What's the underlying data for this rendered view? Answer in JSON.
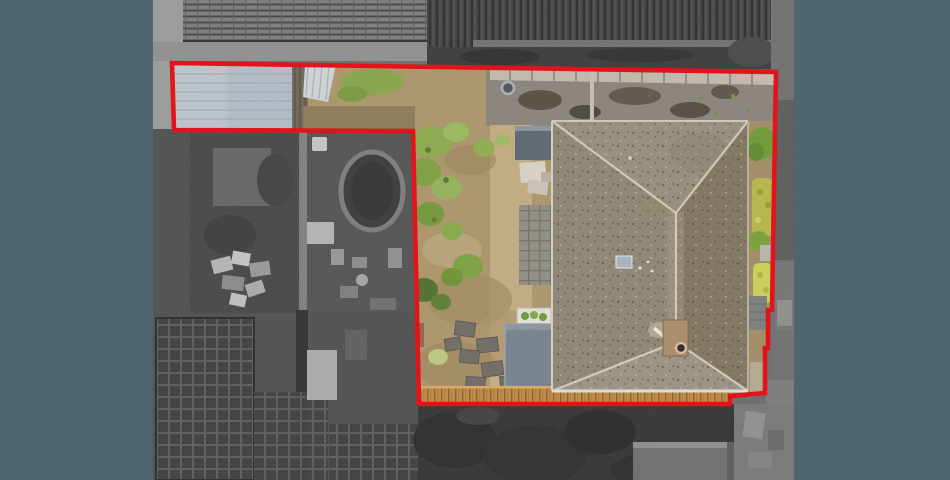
{
  "scene": {
    "type": "aerial-property-photograph",
    "alt": "Top-down aerial drone photograph of a detached house with a grey hipped roof, rear garden with dry lawn, shrubs, paving and timber decking, and a pale grey outbuilding roof. The property plot is outlined with a thick red boundary line; everything outside the boundary (neighbouring gardens, pool, sheds, roofs, driveway) is desaturated to greyscale. Dark slate-blue bars fill the left and right edges of the frame.",
    "visible_text": []
  },
  "colors": {
    "backdrop_slate": "#4C6670",
    "boundary_red": "#E2131A",
    "outside_grey": "#6C6C6C",
    "house_roof_grey": "#8E8575",
    "garden_tan": "#B29A72",
    "shed_roof_blue_grey": "#B4BEC6",
    "deck_wood": "#BF8A45",
    "hedge_green": "#7DA03F",
    "hedge_yellow": "#C6CB54"
  },
  "boundary": {
    "path": "M 172,63 L 776,72 L 772,310 L 768,310 L 768,348 L 765,348 L 765,393 L 730,396 L 730,404 L 419,404 L 413,131 L 174,130 Z",
    "stroke_width": "4.6"
  }
}
